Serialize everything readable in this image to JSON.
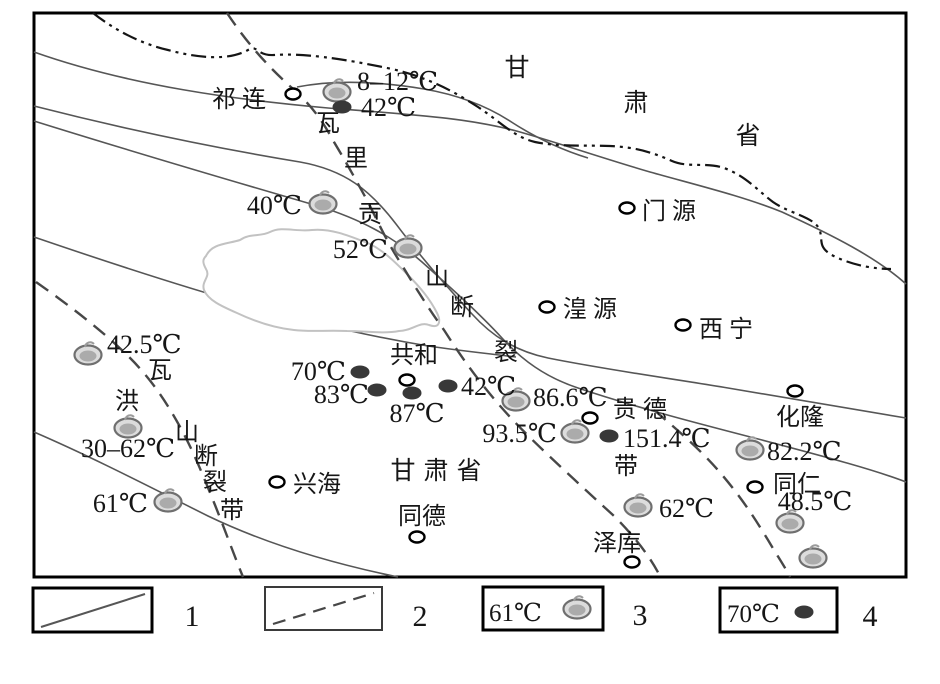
{
  "colors": {
    "background": "#ffffff",
    "frame": "#000000",
    "geo_line": "#565656",
    "boundary_line": "#151515",
    "fault_line": "#474747",
    "lake_outline": "#c2c2c2",
    "warm_spring_fill": "#dcdcdc",
    "warm_spring_core": "#ababab",
    "warm_spring_stroke": "#6f6f6f",
    "boiling_spring_fill": "#383838",
    "city_circle_stroke": "#000000",
    "text": "#161616"
  },
  "region_labels": [
    {
      "text": "甘",
      "x": 521,
      "y": 76
    },
    {
      "text": "肃",
      "x": 640,
      "y": 111
    },
    {
      "text": "省",
      "x": 752,
      "y": 144
    },
    {
      "text": "甘肃省",
      "x": 440,
      "y": 479
    }
  ],
  "fault_names": [
    {
      "name": "wali-gong-shan-fault-zone",
      "chars": [
        {
          "t": "瓦",
          "x": 328,
          "y": 131
        },
        {
          "t": "里",
          "x": 356,
          "y": 166
        },
        {
          "t": "贡",
          "x": 370,
          "y": 222
        },
        {
          "t": "山",
          "x": 437,
          "y": 285
        },
        {
          "t": "断",
          "x": 462,
          "y": 315
        },
        {
          "t": "裂",
          "x": 506,
          "y": 360
        },
        {
          "t": "带",
          "x": 626,
          "y": 474
        }
      ]
    },
    {
      "name": "wa-hong-shan-fault-zone",
      "chars": [
        {
          "t": "瓦",
          "x": 160,
          "y": 378
        },
        {
          "t": "洪",
          "x": 127,
          "y": 409
        },
        {
          "t": "山",
          "x": 187,
          "y": 440
        },
        {
          "t": "断",
          "x": 206,
          "y": 464
        },
        {
          "t": "裂",
          "x": 215,
          "y": 490
        },
        {
          "t": "带",
          "x": 232,
          "y": 518
        }
      ]
    }
  ],
  "cities": [
    {
      "name": "祁连",
      "cx": 293,
      "cy": 94,
      "lx": 242,
      "ly": 107,
      "anchor": "middle",
      "wide": true
    },
    {
      "name": "门源",
      "cx": 627,
      "cy": 208,
      "lx": 642,
      "ly": 219,
      "anchor": "start",
      "wide": true
    },
    {
      "name": "湟源",
      "cx": 547,
      "cy": 307,
      "lx": 563,
      "ly": 317,
      "anchor": "start",
      "wide": true
    },
    {
      "name": "西宁",
      "cx": 683,
      "cy": 325,
      "lx": 699,
      "ly": 337,
      "anchor": "start",
      "wide": true
    },
    {
      "name": "共和",
      "cx": 407,
      "cy": 380,
      "lx": 414,
      "ly": 363,
      "anchor": "middle",
      "wide": false
    },
    {
      "name": "贵德",
      "cx": 590,
      "cy": 418,
      "lx": 613,
      "ly": 417,
      "anchor": "start",
      "wide": true
    },
    {
      "name": "化隆",
      "cx": 795,
      "cy": 391,
      "lx": 800,
      "ly": 425,
      "anchor": "middle",
      "wide": false
    },
    {
      "name": "兴海",
      "cx": 277,
      "cy": 482,
      "lx": 293,
      "ly": 492,
      "anchor": "start",
      "wide": false
    },
    {
      "name": "同德",
      "cx": 417,
      "cy": 537,
      "lx": 422,
      "ly": 524,
      "anchor": "middle",
      "wide": false
    },
    {
      "name": "泽库",
      "cx": 632,
      "cy": 562,
      "lx": 617,
      "ly": 551,
      "anchor": "middle",
      "wide": false
    },
    {
      "name": "同仁",
      "cx": 755,
      "cy": 487,
      "lx": 773,
      "ly": 492,
      "anchor": "start",
      "wide": false
    }
  ],
  "warm_springs": [
    {
      "temp": "8–12℃",
      "cx": 337,
      "cy": 92,
      "lx": 357,
      "ly": 90,
      "anchor": "start"
    },
    {
      "temp": "40℃",
      "cx": 323,
      "cy": 204,
      "lx": 302,
      "ly": 214,
      "anchor": "end"
    },
    {
      "temp": "52℃",
      "cx": 408,
      "cy": 248,
      "lx": 388,
      "ly": 258,
      "anchor": "end"
    },
    {
      "temp": "42.5℃",
      "cx": 88,
      "cy": 355,
      "lx": 107,
      "ly": 353,
      "anchor": "start"
    },
    {
      "temp": "30–62℃",
      "cx": 128,
      "cy": 428,
      "lx": 128,
      "ly": 457,
      "anchor": "middle"
    },
    {
      "temp": "61℃",
      "cx": 168,
      "cy": 502,
      "lx": 148,
      "ly": 512,
      "anchor": "end"
    },
    {
      "temp": "86.6℃",
      "cx": 516,
      "cy": 401,
      "lx": 533,
      "ly": 406,
      "anchor": "start"
    },
    {
      "temp": "93.5℃",
      "cx": 575,
      "cy": 433,
      "lx": 557,
      "ly": 442,
      "anchor": "end"
    },
    {
      "temp": "82.2℃",
      "cx": 750,
      "cy": 450,
      "lx": 767,
      "ly": 460,
      "anchor": "start"
    },
    {
      "temp": "48.5℃",
      "cx": 790,
      "cy": 523,
      "lx": 815,
      "ly": 510,
      "anchor": "middle"
    },
    {
      "temp": "62℃",
      "cx": 638,
      "cy": 507,
      "lx": 659,
      "ly": 517,
      "anchor": "start"
    },
    {
      "temp": "",
      "cx": 813,
      "cy": 558,
      "lx": 0,
      "ly": 0,
      "anchor": "start"
    }
  ],
  "boiling_springs": [
    {
      "temp": "42℃",
      "cx": 342,
      "cy": 107,
      "lx": 361,
      "ly": 116,
      "anchor": "start"
    },
    {
      "temp": "70℃",
      "cx": 360,
      "cy": 372,
      "lx": 346,
      "ly": 380,
      "anchor": "end"
    },
    {
      "temp": "83℃",
      "cx": 377,
      "cy": 390,
      "lx": 369,
      "ly": 403,
      "anchor": "end"
    },
    {
      "temp": "87℃",
      "cx": 412,
      "cy": 393,
      "lx": 417,
      "ly": 422,
      "anchor": "middle"
    },
    {
      "temp": "42℃",
      "cx": 448,
      "cy": 386,
      "lx": 461,
      "ly": 395,
      "anchor": "start"
    },
    {
      "temp": "151.4℃",
      "cx": 609,
      "cy": 436,
      "lx": 623,
      "ly": 447,
      "anchor": "start"
    }
  ],
  "legend": {
    "items": [
      {
        "label": "1",
        "type": "geological-line"
      },
      {
        "label": "2",
        "type": "fault-line"
      },
      {
        "label": "3",
        "type": "warm-spring",
        "sample_temp": "61℃"
      },
      {
        "label": "4",
        "type": "boiling-spring",
        "sample_temp": "70℃"
      }
    ]
  }
}
